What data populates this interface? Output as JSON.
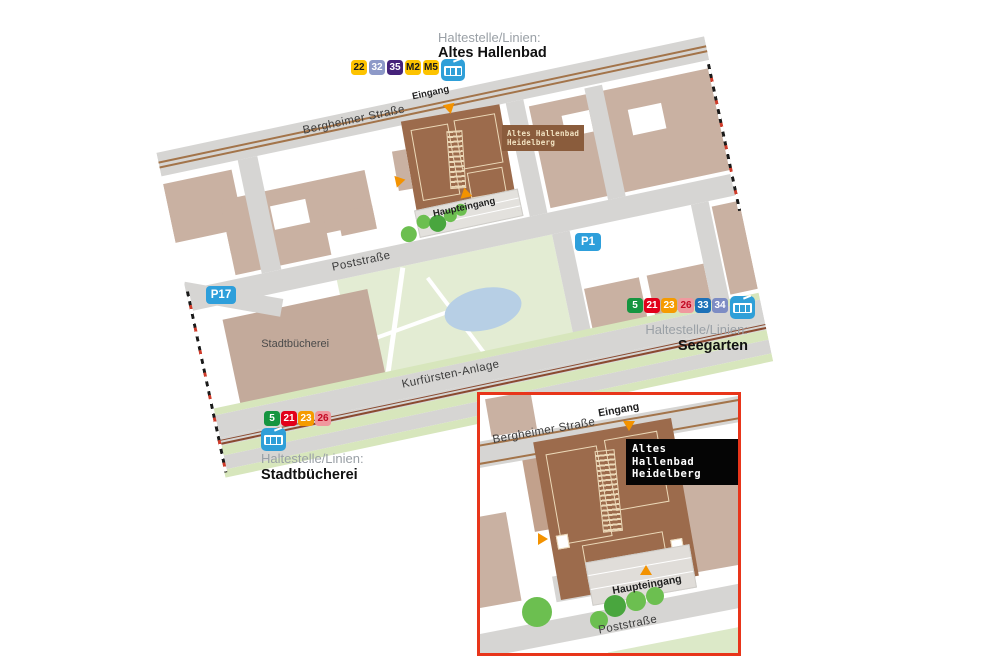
{
  "stops": {
    "altes_hallenbad": {
      "heading": "Haltestelle/Linien:",
      "name": "Altes Hallenbad",
      "lines": [
        {
          "label": "22",
          "bg": "#fdc300",
          "fg": "#1a1a1a"
        },
        {
          "label": "32",
          "bg": "#8d99c8",
          "fg": "#ffffff"
        },
        {
          "label": "35",
          "bg": "#45227a",
          "fg": "#ffffff"
        },
        {
          "label": "M2",
          "bg": "#fdc300",
          "fg": "#1a1a1a"
        },
        {
          "label": "M5",
          "bg": "#fdc300",
          "fg": "#1a1a1a"
        }
      ]
    },
    "seegarten": {
      "heading": "Haltestelle/Linien:",
      "name": "Seegarten",
      "lines": [
        {
          "label": "5",
          "bg": "#169540",
          "fg": "#ffffff"
        },
        {
          "label": "21",
          "bg": "#e2001a",
          "fg": "#ffffff"
        },
        {
          "label": "23",
          "bg": "#f59b00",
          "fg": "#ffffff"
        },
        {
          "label": "26",
          "bg": "#f0989e",
          "fg": "#c30a24"
        },
        {
          "label": "33",
          "bg": "#1d71b8",
          "fg": "#ffffff"
        },
        {
          "label": "34",
          "bg": "#7d8cc4",
          "fg": "#ffffff"
        }
      ]
    },
    "stadtbuecherei": {
      "heading": "Haltestelle/Linien:",
      "name": "Stadtbücherei",
      "lines": [
        {
          "label": "5",
          "bg": "#169540",
          "fg": "#ffffff"
        },
        {
          "label": "21",
          "bg": "#e2001a",
          "fg": "#ffffff"
        },
        {
          "label": "23",
          "bg": "#f59b00",
          "fg": "#ffffff"
        },
        {
          "label": "26",
          "bg": "#f0989e",
          "fg": "#c30a24"
        }
      ]
    }
  },
  "parking": {
    "p1": "P1",
    "p17": "P17"
  },
  "main_map": {
    "streets": {
      "bergheimer": "Bergheimer Straße",
      "poststrasse": "Poststraße",
      "kurfuersten": "Kurfürsten-Anlage"
    },
    "building_labels": {
      "stadtbuecherei": "Stadtbücherei"
    },
    "markers": {
      "eingang": "Eingang",
      "haupteingang": "Haupteingang"
    },
    "sign": {
      "line1": "Altes Hallenbad",
      "line2": "Heidelberg"
    }
  },
  "inset_map": {
    "streets": {
      "bergheimer": "Bergheimer Straße",
      "poststrasse": "Poststraße"
    },
    "markers": {
      "eingang": "Eingang",
      "haupteingang": "Haupteingang"
    },
    "sign": {
      "line1": "Altes Hallenbad",
      "line2": "Heidelberg"
    }
  },
  "colors": {
    "building": "#c9b1a2",
    "hallenbad_building": "#9c6b4c",
    "street": "#d6d5d3",
    "park": "#e3ecd3",
    "pond": "#b7cfe5",
    "tree_light": "#6cbf50",
    "tree_dark": "#49a63e",
    "tram_icon": "#2f9fd8",
    "parking_badge": "#2e9fdb",
    "inset_border": "#e8351a",
    "marker_orange": "#f39200",
    "sign_main_bg": "#8a5c3c",
    "sign_main_fg": "#f2e3c2",
    "sign_inset_bg": "#000000",
    "sign_inset_fg": "#ffffff"
  }
}
